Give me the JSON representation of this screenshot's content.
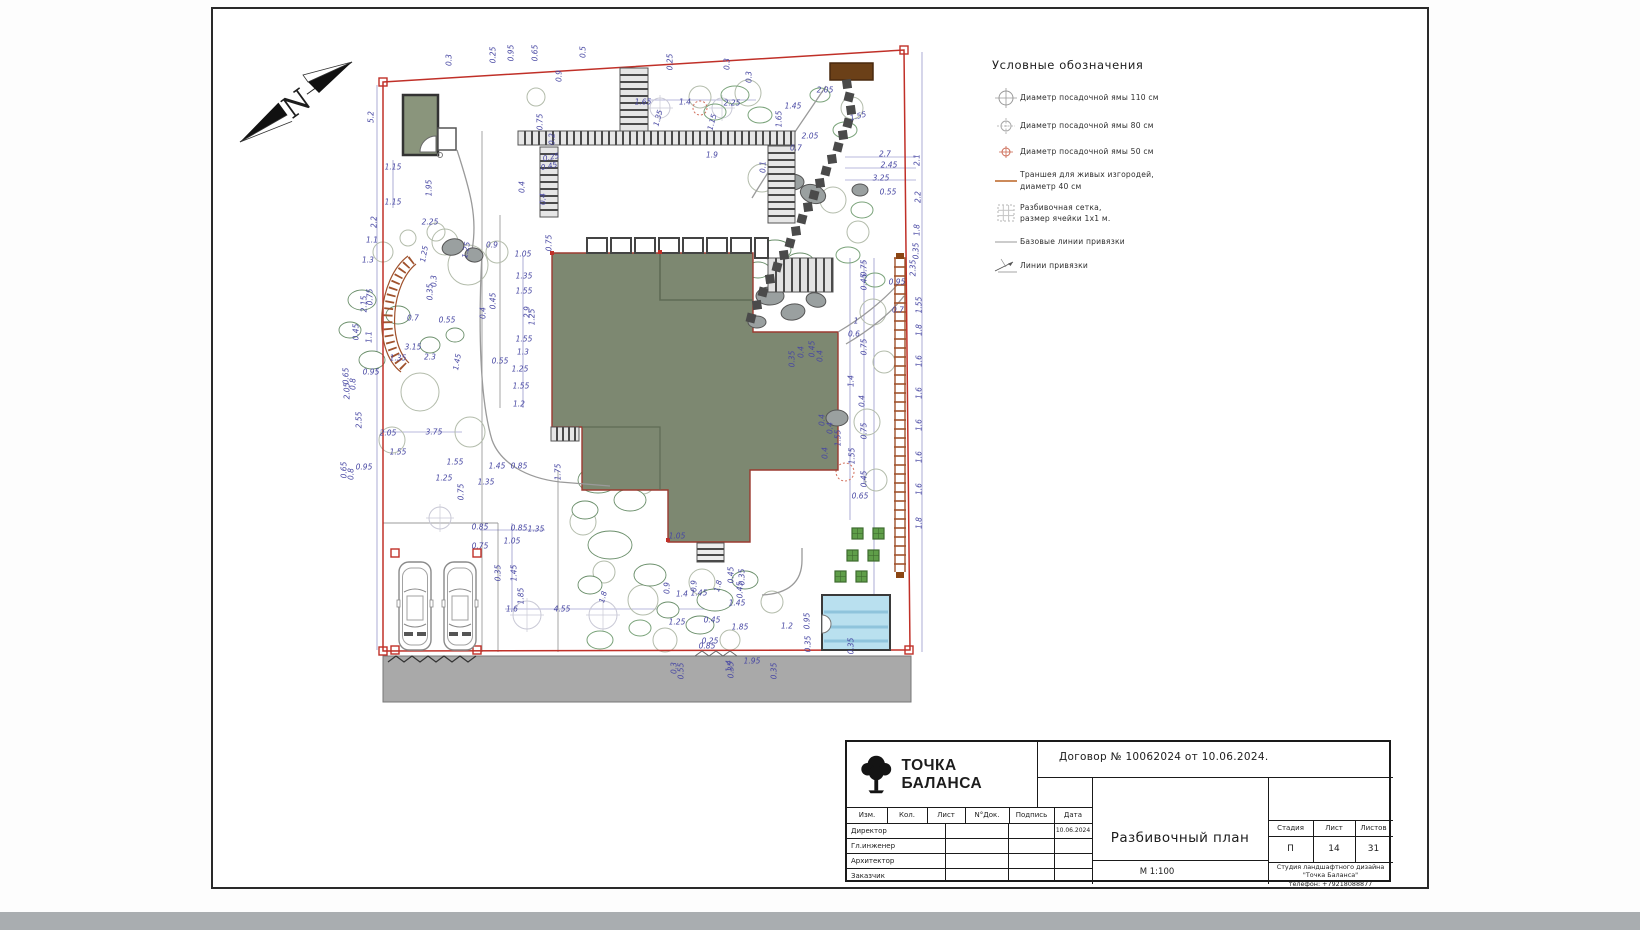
{
  "colors": {
    "boundary_red": "#c03028",
    "dimension_blue": "#4747a3",
    "house_green": "#7d8871",
    "pool_blue": "#b9e0ef",
    "road_gray": "#a9a9a9",
    "trench_brown": "#a0522d",
    "planter_green": "#5f9e49",
    "structure_brown": "#6b4018"
  },
  "north_arrow": {
    "letter": "N"
  },
  "legend": {
    "title": "Условные обозначения",
    "items": [
      {
        "icon": "pit-110-icon",
        "label": "Диаметр посадочной ямы 110 см"
      },
      {
        "icon": "pit-80-icon",
        "label": "Диаметр посадочной ямы 80 см"
      },
      {
        "icon": "pit-50-icon",
        "label": "Диаметр посадочной ямы 50 см"
      },
      {
        "icon": "trench-icon",
        "label": "Траншея для живых изгородей,\nдиаметр 40 см"
      },
      {
        "icon": "grid-icon",
        "label": "Разбивочная сетка,\nразмер ячейки 1х1 м."
      },
      {
        "icon": "baseline-icon",
        "label": "Базовые линии привязки"
      },
      {
        "icon": "tieline-icon",
        "label": "Линии привязки"
      }
    ]
  },
  "title_block": {
    "logo_text": "ТОЧКА БАЛАНСА",
    "contract": "Договор № 10062024 от 10.06.2024.",
    "sig_headers": [
      "Изм.",
      "Кол.",
      "Лист",
      "N°Док.",
      "Подпись",
      "Дата"
    ],
    "sig_rows": [
      {
        "role": "Директор",
        "date": "10.06.2024"
      },
      {
        "role": "Гл.инженер",
        "date": ""
      },
      {
        "role": "Архитектор",
        "date": ""
      },
      {
        "role": "Заказчик",
        "date": ""
      }
    ],
    "doc_title": "Разбивочный план",
    "scale": "М 1:100",
    "stage_label": "Стадия",
    "sheet_label": "Лист",
    "sheets_label": "Листов",
    "stage": "П",
    "sheet": "14",
    "sheets": "31",
    "studio_lines": [
      "Студия ландшафтного дизайна",
      "\"Точка Баланса\"",
      "телефон: +79218088877"
    ]
  },
  "plan": {
    "dimensions": [
      {
        "t": "0.3",
        "x": 449,
        "y": 60,
        "r": -90
      },
      {
        "t": "0.25",
        "x": 493,
        "y": 55,
        "r": -90
      },
      {
        "t": "0.95",
        "x": 511,
        "y": 53,
        "r": -90
      },
      {
        "t": "0.65",
        "x": 535,
        "y": 53,
        "r": -90
      },
      {
        "t": "0.5",
        "x": 583,
        "y": 52,
        "r": -90
      },
      {
        "t": "0.9",
        "x": 559,
        "y": 76,
        "r": -90
      },
      {
        "t": "0.25",
        "x": 670,
        "y": 62,
        "r": -90
      },
      {
        "t": "0.3",
        "x": 727,
        "y": 64,
        "r": -90
      },
      {
        "t": "0.3",
        "x": 749,
        "y": 77,
        "r": -90
      },
      {
        "t": "5.2",
        "x": 371,
        "y": 117,
        "r": -90
      },
      {
        "t": "1.15",
        "x": 393,
        "y": 167,
        "r": 0
      },
      {
        "t": "1.95",
        "x": 429,
        "y": 188,
        "r": -90
      },
      {
        "t": "1.15",
        "x": 393,
        "y": 202,
        "r": 0
      },
      {
        "t": "2.2",
        "x": 374,
        "y": 222,
        "r": -90
      },
      {
        "t": "2.25",
        "x": 430,
        "y": 222,
        "r": 0
      },
      {
        "t": "1.65",
        "x": 643,
        "y": 102,
        "r": 0
      },
      {
        "t": "1.4",
        "x": 685,
        "y": 102,
        "r": 0
      },
      {
        "t": "2.25",
        "x": 732,
        "y": 103,
        "r": 0
      },
      {
        "t": "1.35",
        "x": 658,
        "y": 118,
        "r": -75
      },
      {
        "t": "1.15",
        "x": 712,
        "y": 122,
        "r": -75
      },
      {
        "t": "1.9",
        "x": 712,
        "y": 155,
        "r": 0
      },
      {
        "t": "0.75",
        "x": 540,
        "y": 122,
        "r": -90
      },
      {
        "t": "0.2",
        "x": 552,
        "y": 139,
        "r": -90
      },
      {
        "t": "0.25",
        "x": 551,
        "y": 157,
        "r": -12
      },
      {
        "t": "0.45",
        "x": 549,
        "y": 166,
        "r": -12
      },
      {
        "t": "0.4",
        "x": 522,
        "y": 187,
        "r": -90
      },
      {
        "t": "0.4",
        "x": 543,
        "y": 199,
        "r": -90
      },
      {
        "t": "2.05",
        "x": 825,
        "y": 90,
        "r": 0
      },
      {
        "t": "1.45",
        "x": 793,
        "y": 106,
        "r": 0
      },
      {
        "t": "1.65",
        "x": 779,
        "y": 119,
        "r": -90
      },
      {
        "t": "1.55",
        "x": 858,
        "y": 116,
        "r": -15
      },
      {
        "t": "2.05",
        "x": 810,
        "y": 136,
        "r": 0
      },
      {
        "t": "0.7",
        "x": 796,
        "y": 148,
        "r": 0
      },
      {
        "t": "0.1",
        "x": 763,
        "y": 167,
        "r": -90
      },
      {
        "t": "2.7",
        "x": 885,
        "y": 154,
        "r": 0
      },
      {
        "t": "2.45",
        "x": 889,
        "y": 165,
        "r": 0
      },
      {
        "t": "3.25",
        "x": 881,
        "y": 178,
        "r": 0
      },
      {
        "t": "0.55",
        "x": 888,
        "y": 192,
        "r": 0
      },
      {
        "t": "2.1",
        "x": 917,
        "y": 160,
        "r": -90
      },
      {
        "t": "2.2",
        "x": 918,
        "y": 197,
        "r": -90
      },
      {
        "t": "1.8",
        "x": 917,
        "y": 230,
        "r": -90
      },
      {
        "t": "0.35",
        "x": 916,
        "y": 251,
        "r": -90
      },
      {
        "t": "1.1",
        "x": 372,
        "y": 240,
        "r": 0
      },
      {
        "t": "1.3",
        "x": 368,
        "y": 260,
        "r": 0
      },
      {
        "t": "1.25",
        "x": 424,
        "y": 254,
        "r": -80
      },
      {
        "t": "1.25",
        "x": 466,
        "y": 250,
        "r": -80
      },
      {
        "t": "0.9",
        "x": 492,
        "y": 245,
        "r": 0
      },
      {
        "t": "2.15",
        "x": 364,
        "y": 304,
        "r": -90
      },
      {
        "t": "0.75",
        "x": 370,
        "y": 297,
        "r": -90
      },
      {
        "t": "0.3",
        "x": 434,
        "y": 281,
        "r": -90
      },
      {
        "t": "0.35",
        "x": 430,
        "y": 292,
        "r": -90
      },
      {
        "t": "0.45",
        "x": 356,
        "y": 332,
        "r": -90
      },
      {
        "t": "1.1",
        "x": 369,
        "y": 337,
        "r": -90
      },
      {
        "t": "0.7",
        "x": 413,
        "y": 318,
        "r": 0
      },
      {
        "t": "0.55",
        "x": 447,
        "y": 320,
        "r": 0
      },
      {
        "t": "0.4",
        "x": 483,
        "y": 313,
        "r": -90
      },
      {
        "t": "0.45",
        "x": 493,
        "y": 301,
        "r": -90
      },
      {
        "t": "3.15",
        "x": 413,
        "y": 347,
        "r": 0
      },
      {
        "t": "1.35",
        "x": 398,
        "y": 358,
        "r": 0
      },
      {
        "t": "2.3",
        "x": 430,
        "y": 357,
        "r": 0
      },
      {
        "t": "1.45",
        "x": 457,
        "y": 362,
        "r": -80
      },
      {
        "t": "0.95",
        "x": 371,
        "y": 372,
        "r": 0
      },
      {
        "t": "0.65",
        "x": 346,
        "y": 376,
        "r": -90
      },
      {
        "t": "0.8",
        "x": 353,
        "y": 384,
        "r": -90
      },
      {
        "t": "0.55",
        "x": 500,
        "y": 361,
        "r": 0
      },
      {
        "t": "1.05",
        "x": 523,
        "y": 254,
        "r": 0
      },
      {
        "t": "0.75",
        "x": 549,
        "y": 243,
        "r": -90
      },
      {
        "t": "1.35",
        "x": 524,
        "y": 276,
        "r": 0
      },
      {
        "t": "1.55",
        "x": 524,
        "y": 291,
        "r": 0
      },
      {
        "t": "2.9",
        "x": 527,
        "y": 312,
        "r": -90
      },
      {
        "t": "1.25",
        "x": 532,
        "y": 317,
        "r": -90
      },
      {
        "t": "1.55",
        "x": 524,
        "y": 339,
        "r": 0
      },
      {
        "t": "1.3",
        "x": 523,
        "y": 352,
        "r": 0
      },
      {
        "t": "1.25",
        "x": 520,
        "y": 369,
        "r": 0
      },
      {
        "t": "1.55",
        "x": 521,
        "y": 386,
        "r": 0
      },
      {
        "t": "1.2",
        "x": 519,
        "y": 404,
        "r": 0
      },
      {
        "t": "1.75",
        "x": 558,
        "y": 472,
        "r": -90
      },
      {
        "t": "0.35",
        "x": 792,
        "y": 359,
        "r": -90
      },
      {
        "t": "0.4",
        "x": 801,
        "y": 352,
        "r": -90
      },
      {
        "t": "0.45",
        "x": 812,
        "y": 349,
        "r": -90
      },
      {
        "t": "0.4",
        "x": 820,
        "y": 356,
        "r": -90
      },
      {
        "t": "0.4",
        "x": 822,
        "y": 420,
        "r": -90
      },
      {
        "t": "0.4",
        "x": 830,
        "y": 428,
        "r": -90
      },
      {
        "t": "1.55",
        "x": 838,
        "y": 438,
        "r": -90
      },
      {
        "t": "0.4",
        "x": 825,
        "y": 453,
        "r": -90
      },
      {
        "t": "2.35",
        "x": 913,
        "y": 268,
        "r": -90
      },
      {
        "t": "0.95",
        "x": 897,
        "y": 282,
        "r": 0
      },
      {
        "t": "1.55",
        "x": 919,
        "y": 305,
        "r": -90
      },
      {
        "t": "0.7",
        "x": 898,
        "y": 310,
        "r": 0
      },
      {
        "t": "1.8",
        "x": 919,
        "y": 330,
        "r": -90
      },
      {
        "t": "1.6",
        "x": 919,
        "y": 361,
        "r": -90
      },
      {
        "t": "1.6",
        "x": 919,
        "y": 393,
        "r": -90
      },
      {
        "t": "1.6",
        "x": 919,
        "y": 425,
        "r": -90
      },
      {
        "t": "1.6",
        "x": 919,
        "y": 457,
        "r": -90
      },
      {
        "t": "1.6",
        "x": 919,
        "y": 489,
        "r": -90
      },
      {
        "t": "1.8",
        "x": 919,
        "y": 523,
        "r": -90
      },
      {
        "t": "0.75",
        "x": 864,
        "y": 268,
        "r": -90
      },
      {
        "t": "0.45",
        "x": 864,
        "y": 282,
        "r": -90
      },
      {
        "t": "1",
        "x": 856,
        "y": 321,
        "r": 0
      },
      {
        "t": "0.6",
        "x": 854,
        "y": 334,
        "r": 0
      },
      {
        "t": "0.75",
        "x": 864,
        "y": 347,
        "r": -90
      },
      {
        "t": "1.4",
        "x": 851,
        "y": 381,
        "r": -90
      },
      {
        "t": "0.4",
        "x": 862,
        "y": 401,
        "r": -90
      },
      {
        "t": "0.75",
        "x": 864,
        "y": 431,
        "r": -90
      },
      {
        "t": "1.55",
        "x": 852,
        "y": 456,
        "r": -90
      },
      {
        "t": "0.45",
        "x": 864,
        "y": 479,
        "r": -90
      },
      {
        "t": "0.65",
        "x": 860,
        "y": 496,
        "r": 0
      },
      {
        "t": "2.05",
        "x": 347,
        "y": 391,
        "r": -90
      },
      {
        "t": "2.55",
        "x": 359,
        "y": 420,
        "r": -90
      },
      {
        "t": "2.05",
        "x": 388,
        "y": 433,
        "r": 0
      },
      {
        "t": "3.75",
        "x": 434,
        "y": 432,
        "r": 0
      },
      {
        "t": "1.55",
        "x": 398,
        "y": 452,
        "r": 0
      },
      {
        "t": "1.55",
        "x": 455,
        "y": 462,
        "r": 0
      },
      {
        "t": "1.45",
        "x": 497,
        "y": 466,
        "r": 0
      },
      {
        "t": "0.85",
        "x": 519,
        "y": 466,
        "r": 0
      },
      {
        "t": "1.25",
        "x": 444,
        "y": 478,
        "r": 0
      },
      {
        "t": "1.35",
        "x": 486,
        "y": 482,
        "r": 0
      },
      {
        "t": "0.75",
        "x": 461,
        "y": 492,
        "r": -90
      },
      {
        "t": "0.65",
        "x": 344,
        "y": 470,
        "r": -90
      },
      {
        "t": "0.8",
        "x": 351,
        "y": 474,
        "r": -90
      },
      {
        "t": "0.95",
        "x": 364,
        "y": 467,
        "r": 0
      },
      {
        "t": "0.85",
        "x": 480,
        "y": 527,
        "r": 0
      },
      {
        "t": "0.85",
        "x": 519,
        "y": 528,
        "r": 0
      },
      {
        "t": "1.35",
        "x": 536,
        "y": 529,
        "r": 0
      },
      {
        "t": "1.05",
        "x": 512,
        "y": 541,
        "r": 0
      },
      {
        "t": "0.75",
        "x": 480,
        "y": 546,
        "r": 0
      },
      {
        "t": "0.35",
        "x": 498,
        "y": 573,
        "r": -90
      },
      {
        "t": "1.45",
        "x": 514,
        "y": 573,
        "r": -90
      },
      {
        "t": "1.85",
        "x": 521,
        "y": 596,
        "r": -90
      },
      {
        "t": "1.6",
        "x": 512,
        "y": 609,
        "r": 0
      },
      {
        "t": "4.55",
        "x": 562,
        "y": 609,
        "r": 0
      },
      {
        "t": "1.8",
        "x": 603,
        "y": 597,
        "r": -75
      },
      {
        "t": "1.8",
        "x": 718,
        "y": 586,
        "r": -75
      },
      {
        "t": "1.05",
        "x": 677,
        "y": 536,
        "r": 0
      },
      {
        "t": "0.9",
        "x": 667,
        "y": 588,
        "r": -90
      },
      {
        "t": "1.4",
        "x": 682,
        "y": 594,
        "r": 0
      },
      {
        "t": "0.9",
        "x": 694,
        "y": 586,
        "r": -90
      },
      {
        "t": "1.45",
        "x": 699,
        "y": 593,
        "r": 0
      },
      {
        "t": "0.45",
        "x": 731,
        "y": 575,
        "r": -90
      },
      {
        "t": "0.35",
        "x": 742,
        "y": 577,
        "r": -90
      },
      {
        "t": "0.45",
        "x": 740,
        "y": 590,
        "r": -90
      },
      {
        "t": "1.45",
        "x": 737,
        "y": 603,
        "r": 0
      },
      {
        "t": "1.25",
        "x": 677,
        "y": 622,
        "r": 0
      },
      {
        "t": "0.45",
        "x": 712,
        "y": 620,
        "r": 0
      },
      {
        "t": "1.85",
        "x": 740,
        "y": 627,
        "r": 0
      },
      {
        "t": "1.2",
        "x": 787,
        "y": 626,
        "r": 0
      },
      {
        "t": "0.95",
        "x": 807,
        "y": 621,
        "r": -90
      },
      {
        "t": "0.25",
        "x": 710,
        "y": 641,
        "r": 0
      },
      {
        "t": "0.85",
        "x": 707,
        "y": 646,
        "r": 0
      },
      {
        "t": "1.95",
        "x": 752,
        "y": 661,
        "r": 0
      },
      {
        "t": "1.4",
        "x": 729,
        "y": 666,
        "r": -90
      },
      {
        "t": "0.3",
        "x": 674,
        "y": 668,
        "r": -90
      },
      {
        "t": "0.55",
        "x": 681,
        "y": 671,
        "r": -90
      },
      {
        "t": "0.35",
        "x": 731,
        "y": 670,
        "r": -90
      },
      {
        "t": "0.35",
        "x": 774,
        "y": 671,
        "r": -90
      },
      {
        "t": "0.35",
        "x": 808,
        "y": 644,
        "r": -90
      },
      {
        "t": "0.35",
        "x": 851,
        "y": 646,
        "r": -90
      }
    ]
  }
}
